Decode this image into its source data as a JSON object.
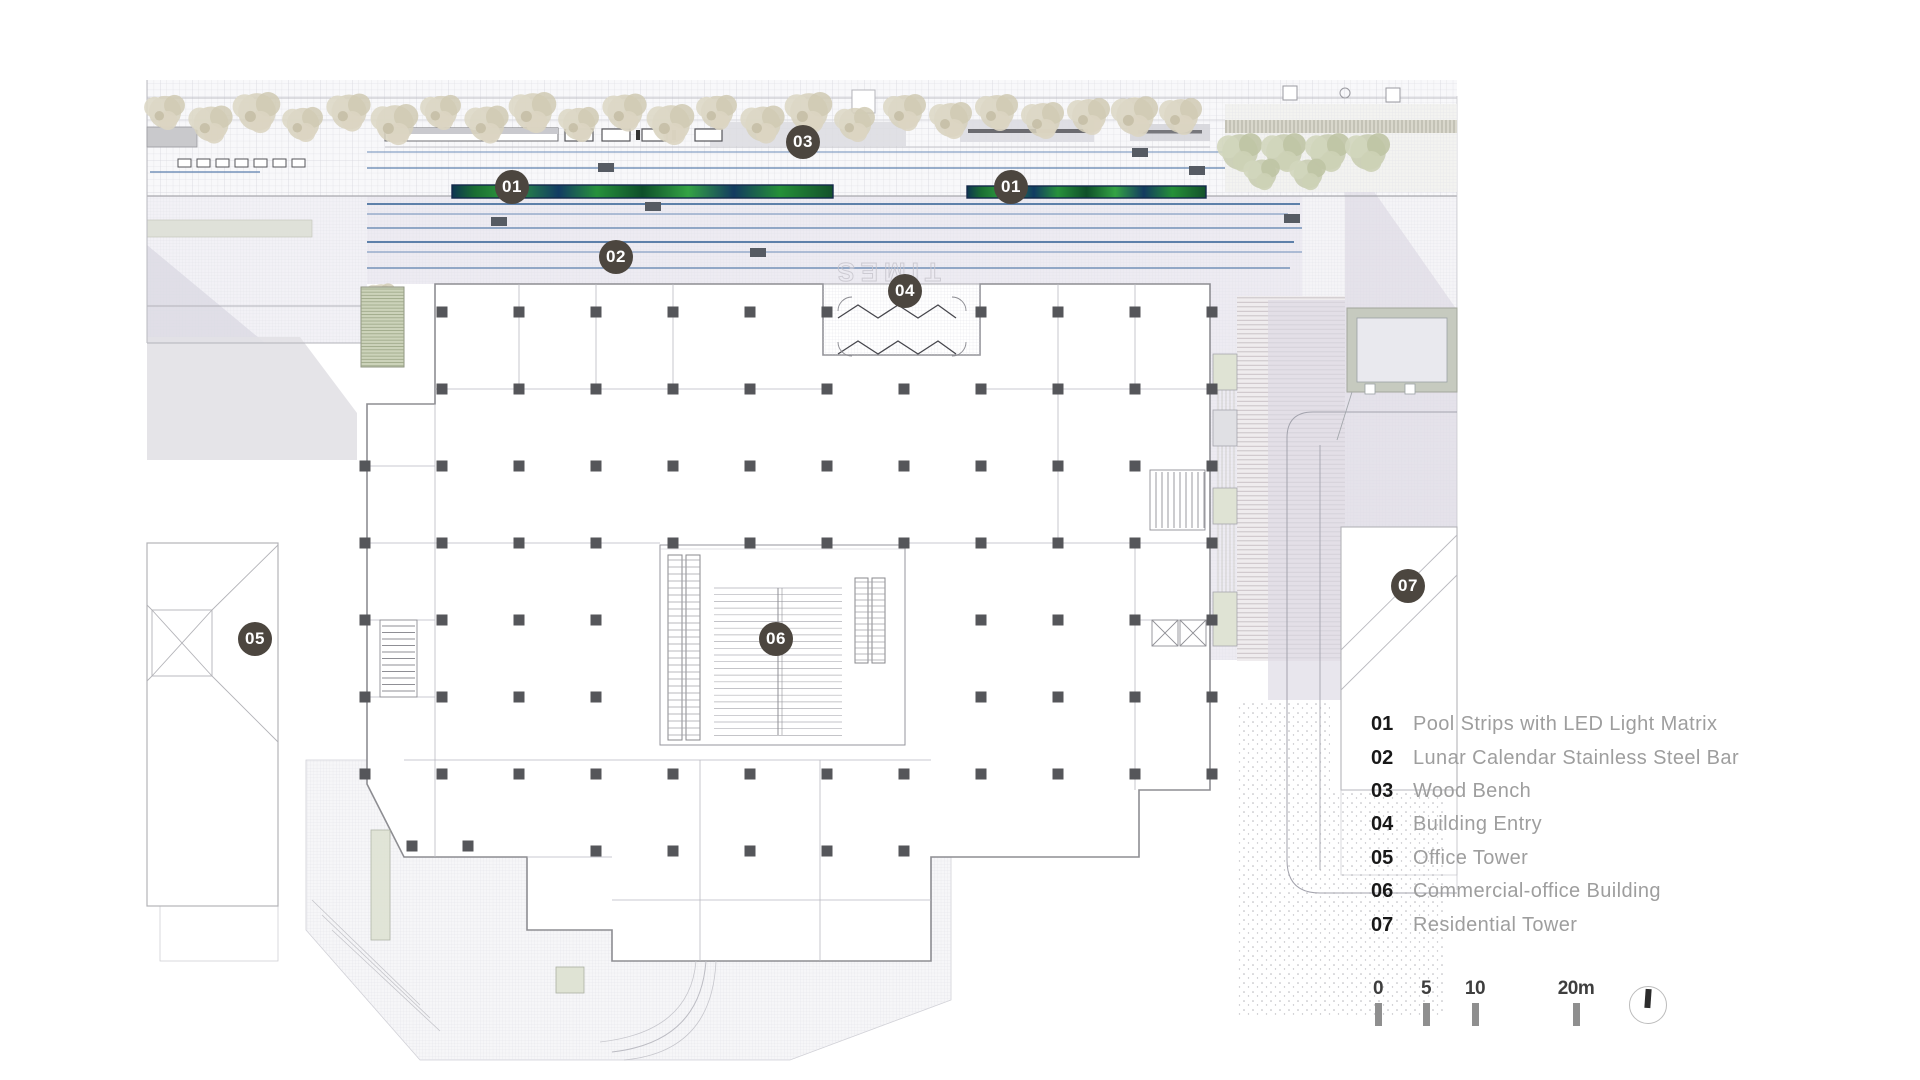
{
  "plan_text": {
    "etched_label": "TIMES"
  },
  "markers": [
    {
      "label": "01",
      "x": 512,
      "y": 187
    },
    {
      "label": "01",
      "x": 1011,
      "y": 187
    },
    {
      "label": "02",
      "x": 616,
      "y": 257
    },
    {
      "label": "03",
      "x": 803,
      "y": 142
    },
    {
      "label": "04",
      "x": 905,
      "y": 291
    },
    {
      "label": "05",
      "x": 255,
      "y": 639
    },
    {
      "label": "06",
      "x": 776,
      "y": 639
    },
    {
      "label": "07",
      "x": 1408,
      "y": 586
    }
  ],
  "legend": {
    "items": [
      {
        "num": "01",
        "label": "Pool Strips with LED Light Matrix"
      },
      {
        "num": "02",
        "label": "Lunar Calendar Stainless Steel Bar"
      },
      {
        "num": "03",
        "label": "Wood Bench"
      },
      {
        "num": "04",
        "label": "Building Entry"
      },
      {
        "num": "05",
        "label": "Office Tower"
      },
      {
        "num": "06",
        "label": "Commercial-office Building"
      },
      {
        "num": "07",
        "label": "Residential Tower"
      }
    ]
  },
  "scale_bar": {
    "labels": [
      "0",
      "5",
      "10",
      "20m"
    ]
  },
  "colors": {
    "marker_bg": "#4c463f",
    "legend_number": "#181818",
    "legend_text": "#9e9e9e",
    "pool_green": "#2f9c3f",
    "pool_navy": "#13294a",
    "steel_bar_blue": "#49719f",
    "scale_tick": "#8f8f8f",
    "tree_beige": "#d7d1bc",
    "tree_green": "#c9cdb1",
    "shadow_lavender": "#dbd9e3"
  }
}
